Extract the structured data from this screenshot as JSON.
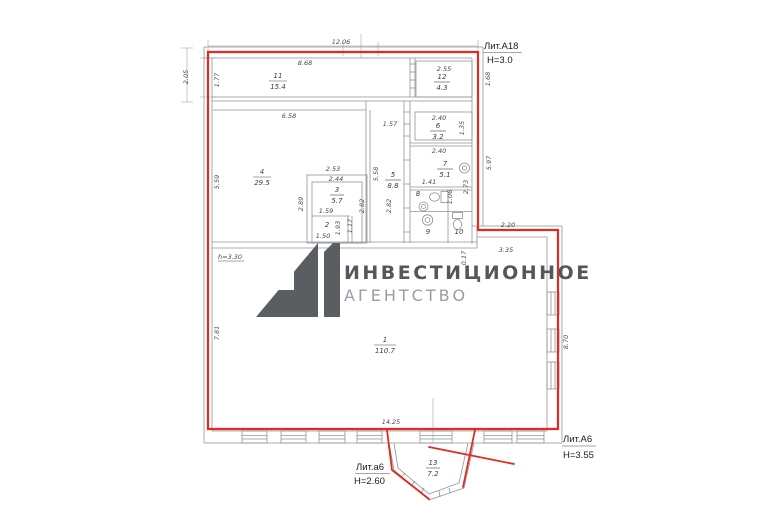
{
  "plan": {
    "litA18": {
      "name": "Лит.А18",
      "h": "Н=3.0"
    },
    "litA6": {
      "name": "Лит.А6",
      "h": "Н=3.55"
    },
    "lita6": {
      "name": "Лит.а6",
      "h": "Н=2.60"
    },
    "ceiling_note": "h=3.30",
    "rooms": [
      {
        "num": "1",
        "area": "110.7"
      },
      {
        "num": "2",
        "area": ""
      },
      {
        "num": "3",
        "area": "5.7"
      },
      {
        "num": "4",
        "area": "29.5"
      },
      {
        "num": "5",
        "area": "8.8"
      },
      {
        "num": "6",
        "area": "3.2"
      },
      {
        "num": "7",
        "area": "5.1"
      },
      {
        "num": "8",
        "area": ""
      },
      {
        "num": "9",
        "area": ""
      },
      {
        "num": "10",
        "area": ""
      },
      {
        "num": "11",
        "area": "15.4"
      },
      {
        "num": "12",
        "area": "4.3"
      },
      {
        "num": "13",
        "area": "7.2"
      }
    ],
    "dims": [
      "12.06",
      "2.05",
      "1.77",
      "8.68",
      "2.55",
      "1.68",
      "6.58",
      "1.57",
      "2.40",
      "1.35",
      "2.40",
      "5.97",
      "5.59",
      "2.53",
      "2.44",
      "5.58",
      "2.89",
      "2.82",
      "2.82",
      "2.73",
      "1.41",
      "1.06",
      "1.59",
      "1.93",
      "1.17",
      "1.50",
      "0.17",
      "2.20",
      "3.35",
      "7.81",
      "8.70",
      "14.25"
    ]
  },
  "watermark": {
    "line1": "ИНВЕСТИЦИОННОЕ",
    "line2": "АГЕНТСТВО"
  },
  "colors": {
    "outline_red": "#e02a22",
    "wall_gray": "#8f9397",
    "dim_text": "#4a4a4a",
    "label_black": "#1b1b1b",
    "watermark_dark": "#53585c",
    "watermark_light": "#989ea3",
    "background": "#ffffff"
  }
}
